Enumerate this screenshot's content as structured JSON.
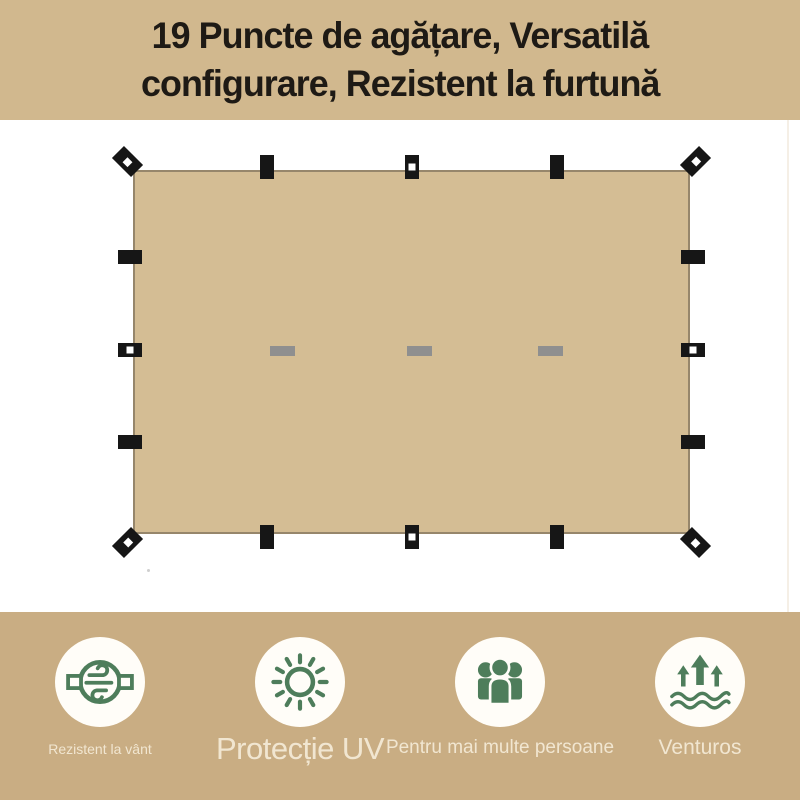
{
  "header": {
    "title_line1": "19 Puncte de agățare, Versatilă",
    "title_line2": "configurare, Rezistent la furtună"
  },
  "tarp": {
    "corner_loops": 4,
    "edge_loops": 12,
    "velcro_strips": 3
  },
  "features": [
    {
      "icon": "wind-resistant-icon",
      "label": "Rezistent la vânt"
    },
    {
      "icon": "uv-protection-icon",
      "label": "Protecție UV"
    },
    {
      "icon": "multi-person-icon",
      "label": "Pentru mai multe persoane"
    },
    {
      "icon": "ventilation-icon",
      "label": "Venturos"
    }
  ],
  "colors": {
    "banner_bg": "#d1b88e",
    "footer_bg": "#c9ad83",
    "tarp_fill": "#d4bd94",
    "tarp_border": "#96866b",
    "tab_black": "#161616",
    "velcro_gray": "#8f8f8f",
    "icon_green": "#4e7d5b",
    "icon_circle_bg": "#fffdf8",
    "label_cream": "#f5ecd9",
    "title_color": "#1e1a15"
  }
}
